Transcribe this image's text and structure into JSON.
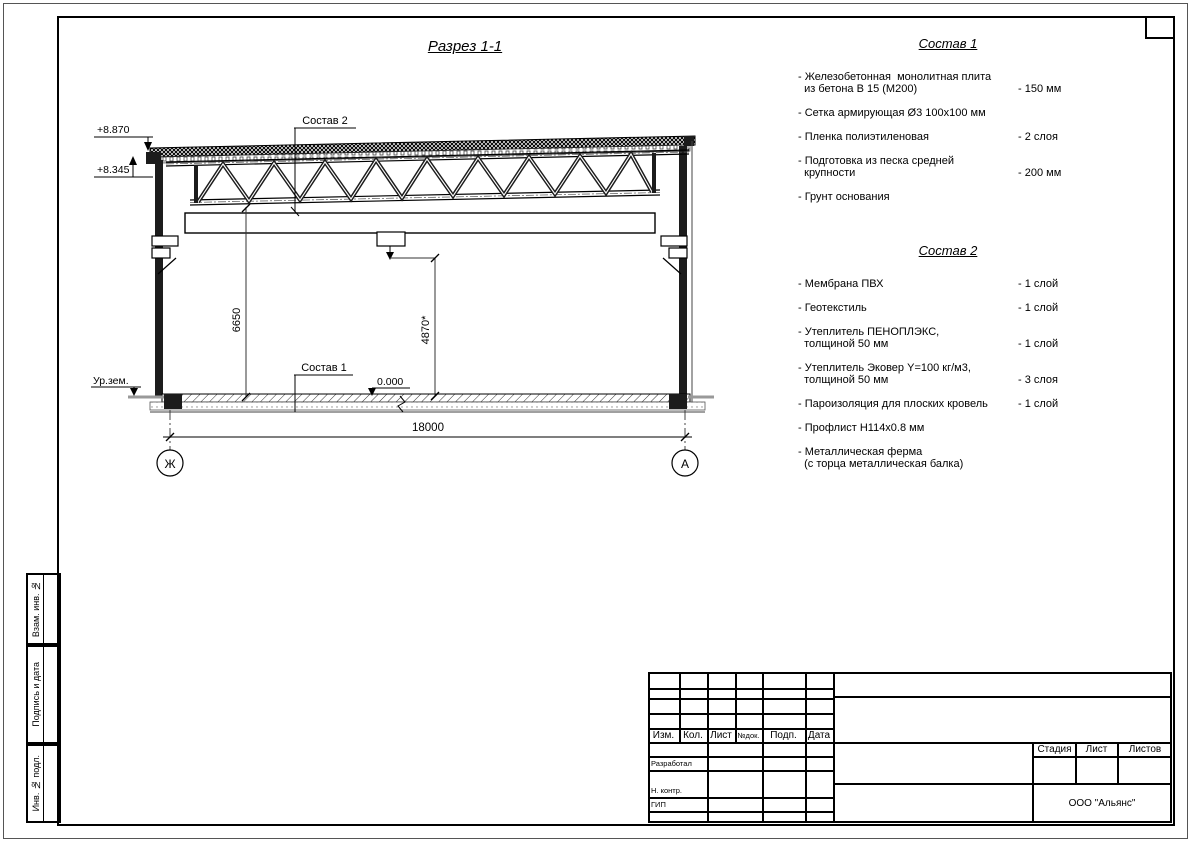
{
  "page": {
    "section_title": "Разрез 1-1"
  },
  "drawing": {
    "labels": {
      "elev_top": "+8.870",
      "elev_low": "+8.345",
      "leader_roof": "Состав 2",
      "leader_floor": "Состав 1",
      "dim_height_left": "6650",
      "dim_height_mid": "4870*",
      "zero_level": "0.000",
      "ground_level": "Ур.зем.",
      "dim_span": "18000",
      "axis_left": "Ж",
      "axis_right": "А"
    }
  },
  "sostav1": {
    "title": "Состав 1",
    "items": [
      {
        "name": "- Железобетонная  монолитная плита\n  из бетона В 15 (М200)",
        "value": "- 150 мм"
      },
      {
        "name": "- Сетка армирующая Ø3 100х100 мм",
        "value": ""
      },
      {
        "name": "- Пленка полиэтиленовая",
        "value": "-  2 слоя"
      },
      {
        "name": "- Подготовка из песка средней\n  крупности",
        "value": "- 200 мм"
      },
      {
        "name": "- Грунт основания",
        "value": ""
      }
    ]
  },
  "sostav2": {
    "title": "Состав 2",
    "items": [
      {
        "name": "- Мембрана ПВХ",
        "value": "- 1 слой"
      },
      {
        "name": "- Геотекстиль",
        "value": "- 1 слой"
      },
      {
        "name": "- Утеплитель ПЕНОПЛЭКС,\n  толщиной 50 мм",
        "value": "- 1 слой"
      },
      {
        "name": "- Утеплитель Эковер Y=100 кг/м3,\n  толщиной 50 мм",
        "value": "- 3 слоя"
      },
      {
        "name": "- Пароизоляция для плоских кровель",
        "value": "- 1 слой"
      },
      {
        "name": "- Профлист Н114х0.8 мм",
        "value": ""
      },
      {
        "name": "- Металлическая ферма\n  (с торца металлическая балка)",
        "value": ""
      }
    ]
  },
  "titleblock": {
    "header_cols": [
      "Изм.",
      "Кол.",
      "Лист",
      "№док.",
      "Подп.",
      "Дата"
    ],
    "roles": [
      "Разработал",
      "Н. контр.",
      "ГИП"
    ],
    "stage_label": "Стадия",
    "sheet_label": "Лист",
    "sheets_label": "Листов",
    "org": "ООО \"Альянс\""
  },
  "side_stamps": [
    "Взам. инв. №",
    "Подпись и дата",
    "Инв. № подл."
  ]
}
